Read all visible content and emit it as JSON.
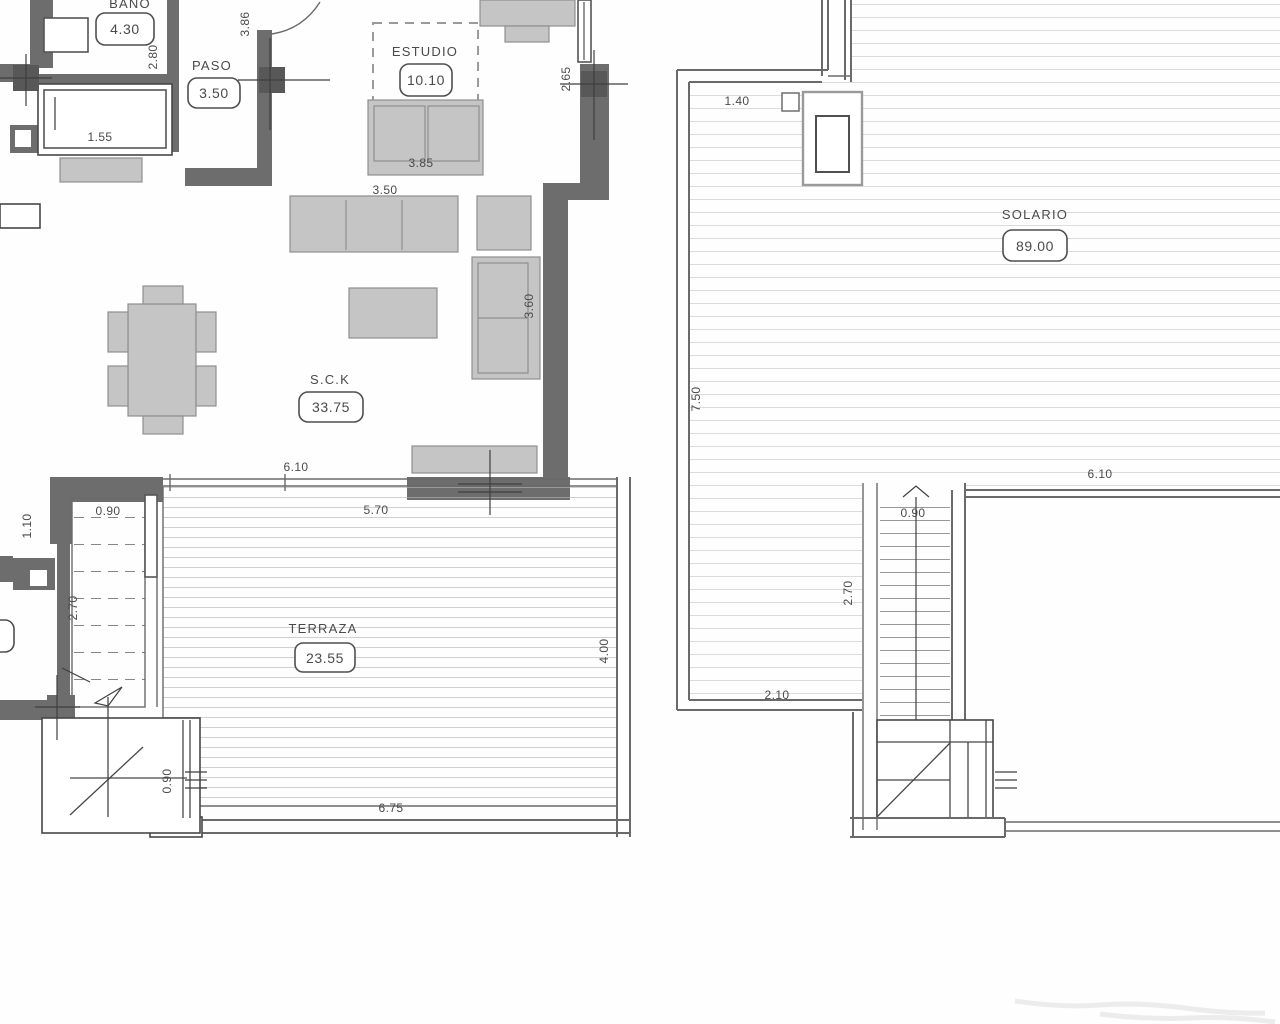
{
  "colors": {
    "bg": "#fefefe",
    "wall": "#6d6d6d",
    "thin": "#6a6a6a",
    "furniture": "#c5c5c5",
    "furniture-stroke": "#8f8f8f",
    "deck": "#b5b5b5",
    "deck-solario": "#c6c6c6",
    "text": "#4a4a4a"
  },
  "left_plan": {
    "bano": {
      "label": "BAÑO",
      "area": "4.30"
    },
    "paso": {
      "label": "PASO",
      "area": "3.50"
    },
    "estudio": {
      "label": "ESTUDIO",
      "area": "10.10"
    },
    "sck": {
      "label": "S.C.K",
      "area": "33.75"
    },
    "terraza": {
      "label": "TERRAZA",
      "area": "23.55"
    },
    "dims": {
      "bano_depth": "2.80",
      "entry": "3.86",
      "closet": "1.55",
      "estudio_bed": "3.85",
      "estudio_window": "2.65",
      "sofa": "3.50",
      "lsofa": "3.60",
      "sck_opening": "6.10",
      "stairs_width": "0.90",
      "landing": "1.10",
      "stairs_run": "2.70",
      "terraza_top": "5.70",
      "terraza_side": "4.00",
      "planter": "0.90",
      "terraza_bottom": "6.75"
    }
  },
  "right_plan": {
    "solario": {
      "label": "SOLARIO",
      "area": "89.00"
    },
    "dims": {
      "chimney_offset": "1.40",
      "side": "7.50",
      "stairs_width": "0.90",
      "stairs_run": "2.70",
      "stairs_base": "2.10",
      "room_top": "6.10"
    }
  }
}
